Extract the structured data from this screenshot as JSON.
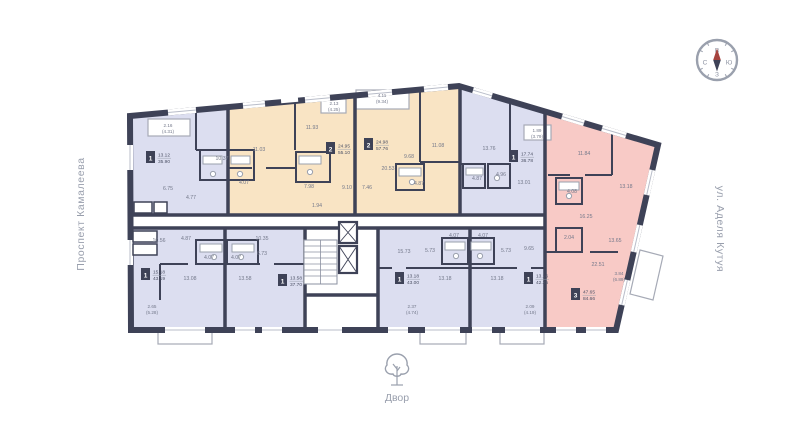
{
  "streets": {
    "left": "Проспект Камалеева",
    "right": "ул. Аделя Кутуя"
  },
  "courtyard": {
    "label": "Двор"
  },
  "compass": {
    "top": "В",
    "right": "Ю",
    "bottom": "З",
    "left": "С"
  },
  "palette": {
    "wall": "#3e4257",
    "lavender": "#dcdef0",
    "beige": "#f9e4c4",
    "pink": "#f8cac6"
  },
  "apartments": [
    {
      "name": "1-room-top-left",
      "color": "lavender",
      "badge": {
        "count": "1",
        "living": "13.12",
        "total": "35.90"
      },
      "rooms": [
        "10.37",
        "6.75",
        "4.77"
      ],
      "balcony": [
        "2.16",
        "(4.31)"
      ]
    },
    {
      "name": "2-room-beige-left",
      "color": "beige",
      "badge": {
        "count": "2",
        "living": "24.95",
        "total": "55.10"
      },
      "rooms": [
        "11.03",
        "11.93",
        "7.98",
        "4.07",
        "1.94",
        "9.10"
      ],
      "balcony": [
        "2.13",
        "(4.25)"
      ]
    },
    {
      "name": "2-room-beige-right",
      "color": "beige",
      "badge": {
        "count": "2",
        "living": "24.98",
        "total": "57.76"
      },
      "rooms": [
        "20.53",
        "9.68",
        "11.08",
        "7.46",
        "4.87"
      ],
      "balcony": [
        "4.11",
        "(9.34)"
      ]
    },
    {
      "name": "1-room-top-right",
      "color": "lavender",
      "badge": {
        "count": "1",
        "living": "17.74",
        "total": "36.78"
      },
      "rooms": [
        "13.76",
        "4.87",
        "4.96",
        "13.01"
      ],
      "balcony": [
        "1.89",
        "(3.79)"
      ]
    },
    {
      "name": "3-room-pink",
      "color": "pink",
      "badge": {
        "count": "3",
        "living": "47.65",
        "total": "84.66"
      },
      "rooms": [
        "11.84",
        "13.18",
        "4.08",
        "16.25",
        "2.04",
        "13.65",
        "22.51"
      ],
      "balcony": [
        "3.84",
        "(6.89)"
      ]
    },
    {
      "name": "1-room-bottom-left",
      "color": "lavender",
      "badge": {
        "count": "1",
        "living": "15.18",
        "total": "43.19"
      },
      "rooms": [
        "10.56",
        "4.87",
        "13.08"
      ],
      "balcony": [
        "2.65",
        "(5.28)"
      ]
    },
    {
      "name": "1-room-bottom-second",
      "color": "lavender",
      "badge": {
        "count": "1",
        "living": "13.58",
        "total": "37.70"
      },
      "rooms": [
        "10.35",
        "4.07",
        "4.07",
        "6.73",
        "13.58"
      ]
    },
    {
      "name": "1-room-bottom-center-left",
      "color": "lavender",
      "badge": {
        "count": "1",
        "living": "13.18",
        "total": "43.00"
      },
      "rooms": [
        "15.73",
        "5.73",
        "4.07",
        "13.18"
      ],
      "balcony": [
        "2.37",
        "(4.74)"
      ]
    },
    {
      "name": "1-room-bottom-center-right",
      "color": "lavender",
      "badge": {
        "count": "1",
        "living": "13.16",
        "total": "42.35"
      },
      "rooms": [
        "4.07",
        "5.73",
        "9.65",
        "13.18"
      ],
      "balcony": [
        "2.09",
        "(4.19)"
      ]
    }
  ]
}
